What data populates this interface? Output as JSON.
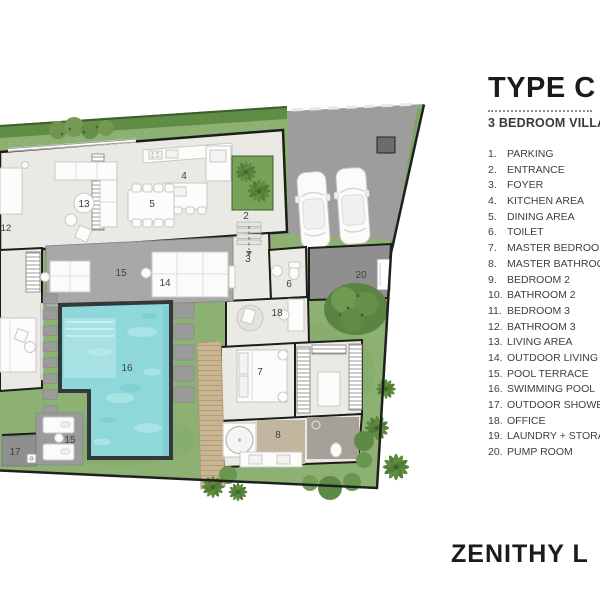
{
  "header": {
    "title": "TYPE C",
    "subtitle": "3 BEDROOM VILLA"
  },
  "legend": {
    "items": [
      {
        "num": "1.",
        "label": "PARKING"
      },
      {
        "num": "2.",
        "label": "ENTRANCE"
      },
      {
        "num": "3.",
        "label": "FOYER"
      },
      {
        "num": "4.",
        "label": "KITCHEN AREA"
      },
      {
        "num": "5.",
        "label": "DINING AREA"
      },
      {
        "num": "6.",
        "label": "TOILET"
      },
      {
        "num": "7.",
        "label": "MASTER BEDROOM"
      },
      {
        "num": "8.",
        "label": "MASTER BATHROOM"
      },
      {
        "num": "9.",
        "label": "BEDROOM 2"
      },
      {
        "num": "10.",
        "label": "BATHROOM 2"
      },
      {
        "num": "11.",
        "label": "BEDROOM 3"
      },
      {
        "num": "12.",
        "label": "BATHROOM 3"
      },
      {
        "num": "13.",
        "label": "LIVING AREA"
      },
      {
        "num": "14.",
        "label": "OUTDOOR LIVING"
      },
      {
        "num": "15.",
        "label": "POOL TERRACE"
      },
      {
        "num": "16.",
        "label": "SWIMMING POOL"
      },
      {
        "num": "17.",
        "label": "OUTDOOR SHOWER"
      },
      {
        "num": "18.",
        "label": "OFFICE"
      },
      {
        "num": "19.",
        "label": "LAUNDRY + STORAGE"
      },
      {
        "num": "20.",
        "label": "PUMP ROOM"
      }
    ]
  },
  "brand": "ZENITHY L",
  "plan": {
    "labels": [
      {
        "text": "2"
      },
      {
        "text": "3"
      },
      {
        "text": "4"
      },
      {
        "text": "5"
      },
      {
        "text": "6"
      },
      {
        "text": "7"
      },
      {
        "text": "8"
      },
      {
        "text": "12"
      },
      {
        "text": "13"
      },
      {
        "text": "14"
      },
      {
        "text": "15"
      },
      {
        "text": "15"
      },
      {
        "text": "16"
      },
      {
        "text": "17"
      },
      {
        "text": "18"
      },
      {
        "text": "20"
      }
    ],
    "colors": {
      "grass": "#8cb173",
      "hedge": "#5f8d45",
      "pool_water": "#8ed8da",
      "pool_ledge": "#a9e2e4",
      "pool_border": "#33383d",
      "concrete": "#9d9d9d",
      "terrace": "#a8a8a8",
      "floor": "#eae9e3",
      "deck": "#c9b591",
      "wall": "#1c1c1c"
    }
  }
}
